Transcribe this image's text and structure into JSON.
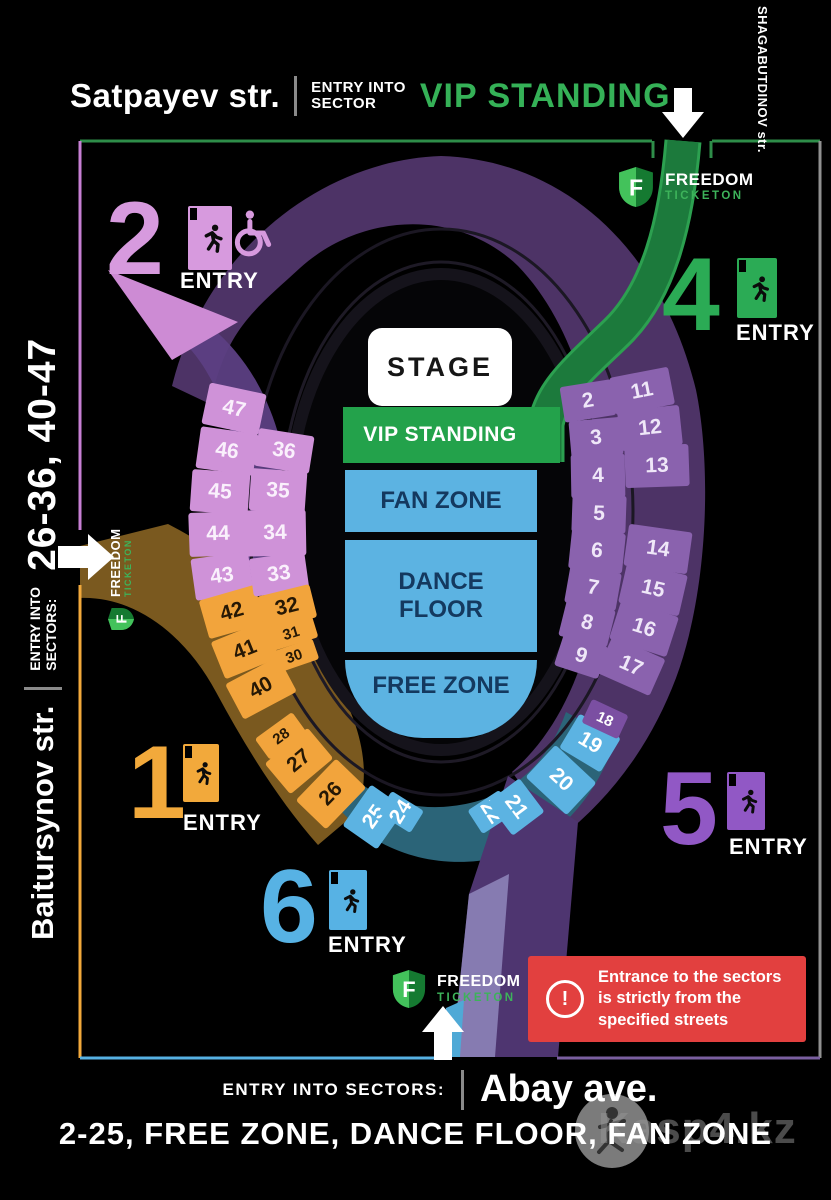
{
  "top_header": {
    "street": "Satpayev str.",
    "entry_line1": "ENTRY INTO",
    "entry_line2": "SECTOR",
    "vip": "VIP STANDING",
    "vip_color": "#35b157"
  },
  "right_header": {
    "street": "SHAGABUTDINOV str."
  },
  "left_rail": {
    "street": "Baitursynov str.",
    "entry_line1": "ENTRY INTO",
    "entry_line2": "SECTORS:",
    "range": "26-36, 40-47"
  },
  "bottom_rail": {
    "entry_label": "ENTRY INTO SECTORS:",
    "street": "Abay ave.",
    "range": "2-25, FREE ZONE, DANCE FLOOR, FAN ZONE"
  },
  "brand": {
    "name": "FREEDOM",
    "sub": "TICKETON"
  },
  "infield": {
    "stage": "STAGE",
    "vip": "VIP STANDING",
    "fan": "FAN ZONE",
    "dance": "DANCE FLOOR",
    "free": "FREE ZONE"
  },
  "entries": [
    {
      "number": "2",
      "label": "ENTRY",
      "color": "#d79ade",
      "accessible": true
    },
    {
      "number": "4",
      "label": "ENTRY",
      "color": "#2bab55",
      "accessible": false
    },
    {
      "number": "1",
      "label": "ENTRY",
      "color": "#f2a93b",
      "accessible": false
    },
    {
      "number": "6",
      "label": "ENTRY",
      "color": "#57b2e4",
      "accessible": false
    },
    {
      "number": "5",
      "label": "ENTRY",
      "color": "#9158c5",
      "accessible": false
    }
  ],
  "sectors": {
    "left_outer": [
      "47",
      "46",
      "45",
      "44",
      "43",
      "42",
      "41",
      "40"
    ],
    "left_inner": [
      "36",
      "35",
      "34",
      "33",
      "32",
      "31",
      "30"
    ],
    "right_inner": [
      "2",
      "3",
      "4",
      "5",
      "6",
      "7",
      "8",
      "9"
    ],
    "right_outer": [
      "11",
      "12",
      "13",
      "14",
      "15",
      "16",
      "17"
    ],
    "bottom_left": [
      "28",
      "27",
      "26",
      "25",
      "24"
    ],
    "bottom_right": [
      "22",
      "21",
      "20",
      "19",
      "18"
    ]
  },
  "warning": {
    "text": "Entrance to the sectors is strictly from the specified streets",
    "color": "#e2403f"
  },
  "watermark": {
    "text": "Kasp4.kz"
  },
  "legend_colors": {
    "pink": "#cf92d8",
    "orange": "#f2a43c",
    "purple": "#8a62ae",
    "blue": "#5cb3e2",
    "vip_green": "#23a24b",
    "sector18_purple": "#7b4fa2",
    "warning_red": "#e2403f",
    "border_grey": "#909090"
  }
}
